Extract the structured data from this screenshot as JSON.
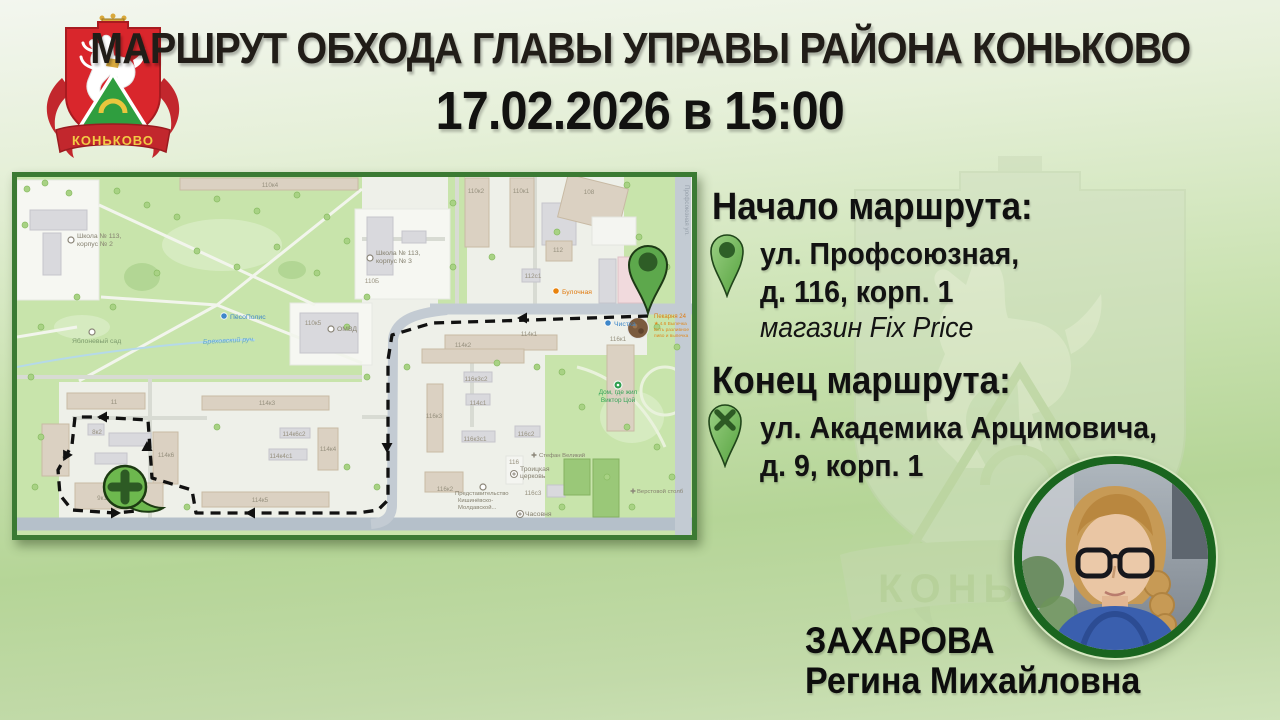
{
  "header": {
    "title": "МАРШРУТ ОБХОДА ГЛАВЫ УПРАВЫ РАЙОНА КОНЬКОВО",
    "datetime": "17.02.2026 в 15:00"
  },
  "logo": {
    "district_name": "КОНЬКОВО"
  },
  "watermark": {
    "district_name": "КОНЬКОВО"
  },
  "route_info": {
    "start": {
      "heading": "Начало маршрута:",
      "address_line1": "ул. Профсоюзная,",
      "address_line2": "д. 116, корп. 1",
      "note": "магазин Fix Price"
    },
    "end": {
      "heading": "Конец маршрута:",
      "address_line1": "ул. Академика Арцимовича,",
      "address_line2": "д. 9, корп. 1"
    }
  },
  "official": {
    "surname": "ЗАХАРОВА",
    "name": "Регина Михайловна"
  },
  "colors": {
    "accent_red": "#d9262c",
    "map_border": "#3b7a33",
    "photo_border": "#1a651f",
    "pin_green": "#6db84e",
    "route_color": "#111111"
  },
  "map": {
    "labels": [
      {
        "t": "110к4",
        "x": 253,
        "y": 10,
        "c": "bnum"
      },
      {
        "t": "110к2",
        "x": 459,
        "y": 16,
        "c": "bnum"
      },
      {
        "t": "110к1",
        "x": 504,
        "y": 16,
        "c": "bnum"
      },
      {
        "t": "108",
        "x": 572,
        "y": 17,
        "c": "bnum"
      },
      {
        "t": "110Б",
        "x": 355,
        "y": 106,
        "c": "bnum"
      },
      {
        "t": "112",
        "x": 541,
        "y": 75,
        "c": "bnum"
      },
      {
        "t": "112с1",
        "x": 516,
        "y": 101,
        "c": "bnum"
      },
      {
        "t": "110к5",
        "x": 296,
        "y": 148,
        "c": "bnum"
      },
      {
        "t": "114к1",
        "x": 512,
        "y": 159,
        "c": "bnum"
      },
      {
        "t": "114к2",
        "x": 446,
        "y": 170,
        "c": "bnum"
      },
      {
        "t": "116к1",
        "x": 601,
        "y": 164,
        "c": "bnum"
      },
      {
        "t": "11",
        "x": 97,
        "y": 227,
        "c": "bnum"
      },
      {
        "t": "8к2",
        "x": 80,
        "y": 257,
        "c": "bnum"
      },
      {
        "t": "9",
        "x": 47,
        "y": 283,
        "c": "bnum"
      },
      {
        "t": "114к6",
        "x": 149,
        "y": 280,
        "c": "bnum"
      },
      {
        "t": "114к3",
        "x": 250,
        "y": 228,
        "c": "bnum"
      },
      {
        "t": "114к6с2",
        "x": 277,
        "y": 259,
        "c": "bnum"
      },
      {
        "t": "114к4с1",
        "x": 264,
        "y": 281,
        "c": "bnum"
      },
      {
        "t": "114к4",
        "x": 311,
        "y": 274,
        "c": "bnum"
      },
      {
        "t": "114к5",
        "x": 243,
        "y": 325,
        "c": "bnum"
      },
      {
        "t": "9к1",
        "x": 85,
        "y": 323,
        "c": "bnum"
      },
      {
        "t": "116к3с2",
        "x": 459,
        "y": 204,
        "c": "bnum"
      },
      {
        "t": "114с1",
        "x": 461,
        "y": 228,
        "c": "bnum"
      },
      {
        "t": "116к3",
        "x": 417,
        "y": 241,
        "c": "bnum"
      },
      {
        "t": "116к3с1",
        "x": 458,
        "y": 264,
        "c": "bnum"
      },
      {
        "t": "116с2",
        "x": 509,
        "y": 259,
        "c": "bnum"
      },
      {
        "t": "116",
        "x": 497,
        "y": 287,
        "c": "bnum"
      },
      {
        "t": "116к2",
        "x": 428,
        "y": 314,
        "c": "bnum"
      },
      {
        "t": "116с3",
        "x": 516,
        "y": 318,
        "c": "bnum"
      },
      {
        "t": "Школа № 113,",
        "x": 60,
        "y": 61,
        "c": "gray"
      },
      {
        "t": "корпус № 2",
        "x": 60,
        "y": 69,
        "c": "gray"
      },
      {
        "t": "Школа № 113,",
        "x": 359,
        "y": 78,
        "c": "gray"
      },
      {
        "t": "корпус № 3",
        "x": 359,
        "y": 86,
        "c": "gray"
      },
      {
        "t": "Яблоневый сад",
        "x": 55,
        "y": 166,
        "c": "garden"
      },
      {
        "t": "ПёсоПолис",
        "x": 213,
        "y": 142,
        "c": "blue"
      },
      {
        "t": "Бреховский руч.",
        "x": 186,
        "y": 167,
        "c": "stream",
        "rot": -3
      },
      {
        "t": "ОМВД",
        "x": 320,
        "y": 154,
        "c": "gray"
      },
      {
        "t": "Булочная",
        "x": 545,
        "y": 117,
        "c": "orange"
      },
      {
        "t": "Чистка",
        "x": 597,
        "y": 149,
        "c": "blue"
      },
      {
        "t": "Пекарня 24",
        "x": 637,
        "y": 141,
        "c": "orange2"
      },
      {
        "t": "★ 4.6 Выпечка",
        "x": 637,
        "y": 148,
        "c": "torange"
      },
      {
        "t": "Есть разливное",
        "x": 637,
        "y": 154,
        "c": "torange"
      },
      {
        "t": "пиво и выпечка",
        "x": 637,
        "y": 160,
        "c": "torange"
      },
      {
        "t": "Стефан Великий",
        "x": 522,
        "y": 280,
        "c": "gray2"
      },
      {
        "t": "Троицкая",
        "x": 503,
        "y": 294,
        "c": "gray"
      },
      {
        "t": "церковь",
        "x": 503,
        "y": 301,
        "c": "gray"
      },
      {
        "t": "Представительство",
        "x": 438,
        "y": 318,
        "c": "gray2"
      },
      {
        "t": "Кишинёвско-",
        "x": 441,
        "y": 325,
        "c": "gray2"
      },
      {
        "t": "Молдавской...",
        "x": 441,
        "y": 332,
        "c": "gray2"
      },
      {
        "t": "Часовня",
        "x": 508,
        "y": 339,
        "c": "gray"
      },
      {
        "t": "Верстовой столб",
        "x": 620,
        "y": 316,
        "c": "gray2"
      },
      {
        "t": "Дом, где жил",
        "x": 601,
        "y": 217,
        "c": "green",
        "a": "middle"
      },
      {
        "t": "Виктор Цой",
        "x": 601,
        "y": 225,
        "c": "green",
        "a": "middle"
      },
      {
        "t": "Профсоюзная ул.",
        "x": 668,
        "y": 8,
        "c": "street",
        "rot": 90
      }
    ],
    "icons": [
      [
        "ring",
        54,
        63
      ],
      [
        "ring",
        353,
        81
      ],
      [
        "ring",
        75,
        155
      ],
      [
        "dot",
        207,
        139,
        "#3f87c9"
      ],
      [
        "ring",
        314,
        152
      ],
      [
        "dot",
        539,
        114,
        "#e8820c"
      ],
      [
        "dot",
        591,
        146,
        "#3f87c9"
      ],
      [
        "photo",
        621,
        151
      ],
      [
        "cross",
        517,
        278
      ],
      [
        "church",
        497,
        297
      ],
      [
        "ring",
        466,
        310
      ],
      [
        "church",
        503,
        337
      ],
      [
        "cross",
        616,
        314
      ],
      [
        "gdot",
        601,
        208
      ]
    ],
    "buildings": [
      [
        13,
        33,
        57,
        20,
        "gray"
      ],
      [
        26,
        56,
        18,
        42,
        "gray"
      ],
      [
        163,
        1,
        178,
        12,
        "beige"
      ],
      [
        350,
        40,
        26,
        58,
        "gray"
      ],
      [
        385,
        54,
        24,
        12,
        "gray"
      ],
      [
        448,
        1,
        24,
        69,
        "beige"
      ],
      [
        493,
        1,
        24,
        69,
        "beige"
      ],
      [
        525,
        26,
        34,
        42,
        "gray"
      ],
      [
        545,
        4,
        62,
        44,
        "beige",
        14
      ],
      [
        575,
        40,
        44,
        28,
        "white"
      ],
      [
        529,
        64,
        26,
        20,
        "beige"
      ],
      [
        601,
        80,
        30,
        46,
        "pink"
      ],
      [
        582,
        82,
        17,
        44,
        "gray"
      ],
      [
        505,
        92,
        18,
        13,
        "gray"
      ],
      [
        283,
        136,
        58,
        40,
        "gray"
      ],
      [
        428,
        158,
        112,
        15,
        "beige"
      ],
      [
        405,
        172,
        102,
        14,
        "beige"
      ],
      [
        590,
        168,
        27,
        86,
        "beige"
      ],
      [
        50,
        216,
        78,
        16,
        "beige"
      ],
      [
        25,
        247,
        27,
        52,
        "beige"
      ],
      [
        71,
        247,
        16,
        11,
        "gray"
      ],
      [
        92,
        256,
        42,
        13,
        "gray"
      ],
      [
        78,
        276,
        32,
        11,
        "gray"
      ],
      [
        136,
        255,
        25,
        52,
        "beige"
      ],
      [
        185,
        219,
        127,
        14,
        "beige"
      ],
      [
        263,
        251,
        30,
        10,
        "gray"
      ],
      [
        252,
        272,
        38,
        11,
        "gray"
      ],
      [
        301,
        251,
        20,
        42,
        "beige"
      ],
      [
        185,
        315,
        127,
        15,
        "beige"
      ],
      [
        58,
        306,
        88,
        26,
        "beige"
      ],
      [
        410,
        207,
        16,
        68,
        "beige"
      ],
      [
        447,
        195,
        28,
        10,
        "gray"
      ],
      [
        449,
        217,
        24,
        11,
        "gray"
      ],
      [
        445,
        254,
        33,
        11,
        "gray"
      ],
      [
        498,
        249,
        25,
        11,
        "gray"
      ],
      [
        489,
        279,
        17,
        28,
        "white"
      ],
      [
        408,
        295,
        38,
        20,
        "beige"
      ],
      [
        530,
        308,
        18,
        12,
        "gray"
      ],
      [
        547,
        282,
        26,
        36,
        "green"
      ],
      [
        576,
        282,
        26,
        58,
        "green"
      ]
    ],
    "route": {
      "points": [
        [
          631,
          139
        ],
        [
          513,
          143
        ],
        [
          415,
          146
        ],
        [
          375,
          158
        ],
        [
          371,
          183
        ],
        [
          371,
          323
        ],
        [
          361,
          333
        ],
        [
          341,
          336
        ],
        [
          179,
          336
        ],
        [
          175,
          313
        ],
        [
          135,
          301
        ],
        [
          131,
          243
        ],
        [
          78,
          240
        ],
        [
          58,
          240
        ],
        [
          55,
          268
        ],
        [
          41,
          293
        ],
        [
          43,
          318
        ],
        [
          55,
          333
        ],
        [
          98,
          336
        ],
        [
          141,
          332
        ]
      ],
      "arrows": [
        [
          508,
          141,
          180
        ],
        [
          370,
          268,
          90
        ],
        [
          236,
          336,
          180
        ],
        [
          130,
          272,
          270
        ],
        [
          88,
          240,
          180
        ],
        [
          50,
          277,
          118
        ],
        [
          96,
          336,
          0
        ]
      ]
    },
    "markers": {
      "start": {
        "x": 631,
        "y": 88,
        "tipy": 136
      },
      "end": {
        "x": 108,
        "y": 310
      }
    }
  }
}
